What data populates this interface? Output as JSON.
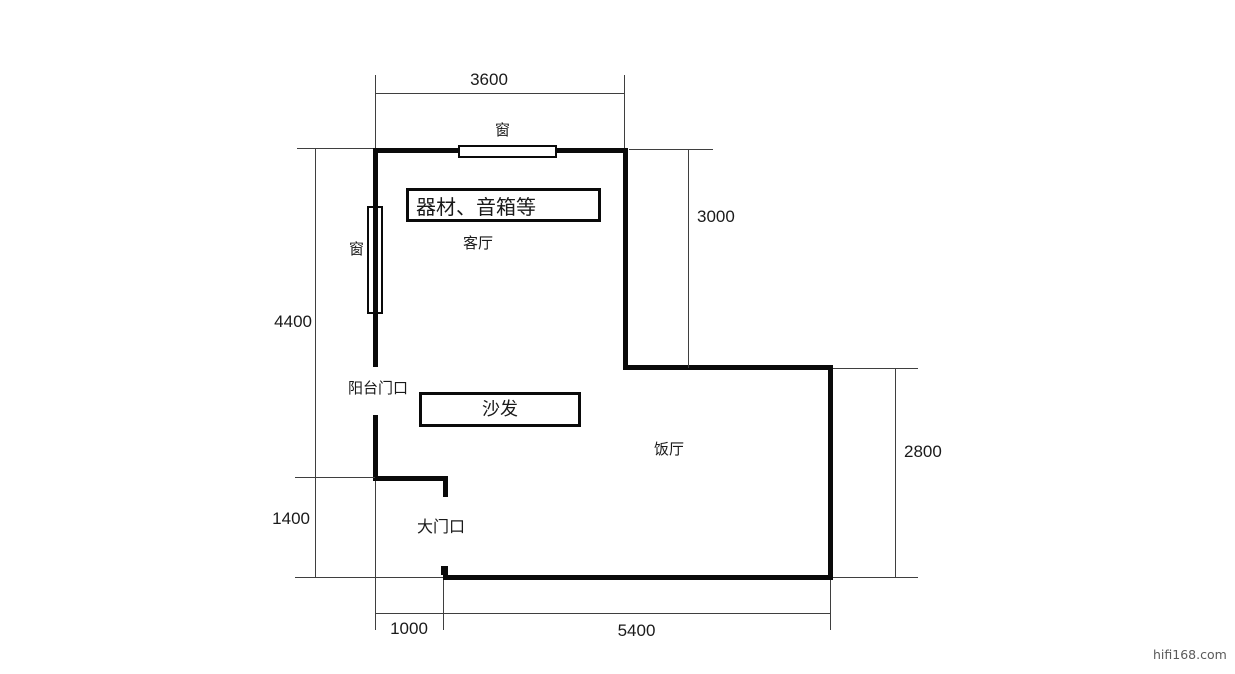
{
  "title": "apartment-floor-plan",
  "colors": {
    "background": "#ffffff",
    "wall": "#0a0a0a",
    "dimension_line": "#3f3f3f",
    "text": "#1a1a1a",
    "watermark": "#5a5a5a"
  },
  "rooms": {
    "living_room": "客厅",
    "dining_room": "饭厅"
  },
  "openings": {
    "window_top": "窗",
    "window_left": "窗",
    "balcony_doorway": "阳台门口",
    "main_entrance": "大门口"
  },
  "furniture": {
    "equipment": "器材、音箱等",
    "sofa": "沙发"
  },
  "dimensions": {
    "top_width": "3600",
    "living_room_depth": "3000",
    "left_total_height": "4400",
    "entry_height": "1400",
    "dining_room_depth": "2800",
    "entry_width": "1000",
    "bottom_width": "5400"
  },
  "watermark": "hifi168.com"
}
